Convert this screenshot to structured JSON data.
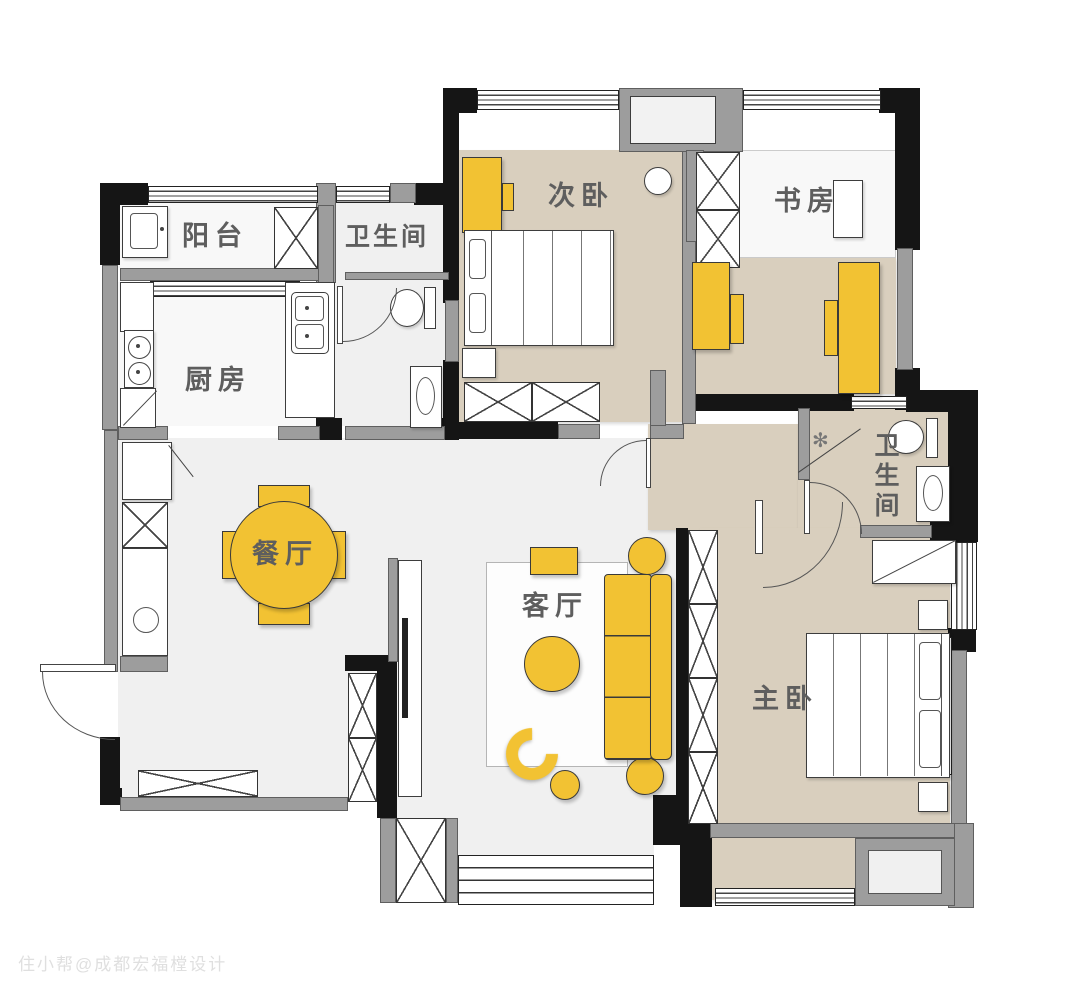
{
  "title": "apartment-floor-plan",
  "watermark": "住小帮@成都宏福樘设计",
  "rooms": {
    "balcony": {
      "label": "阳台"
    },
    "bathroom_top": {
      "label": "卫生间"
    },
    "kitchen": {
      "label": "厨房"
    },
    "second_bedroom": {
      "label": "次卧"
    },
    "study": {
      "label": "书房"
    },
    "bathroom_master": {
      "label": "卫生间"
    },
    "dining": {
      "label": "餐厅"
    },
    "living": {
      "label": "客厅"
    },
    "master_bedroom": {
      "label": "主卧"
    }
  },
  "icons": {
    "shower": "✻"
  },
  "palette": {
    "accent_yellow": "#F2C233",
    "floor_tan": "#D9CFBE",
    "floor_light": "#F0F0F0",
    "wall_black": "#151515",
    "wall_gray": "#9D9D9D",
    "label_gray": "#5E5E5E",
    "watermark_gray": "#DADADA"
  }
}
